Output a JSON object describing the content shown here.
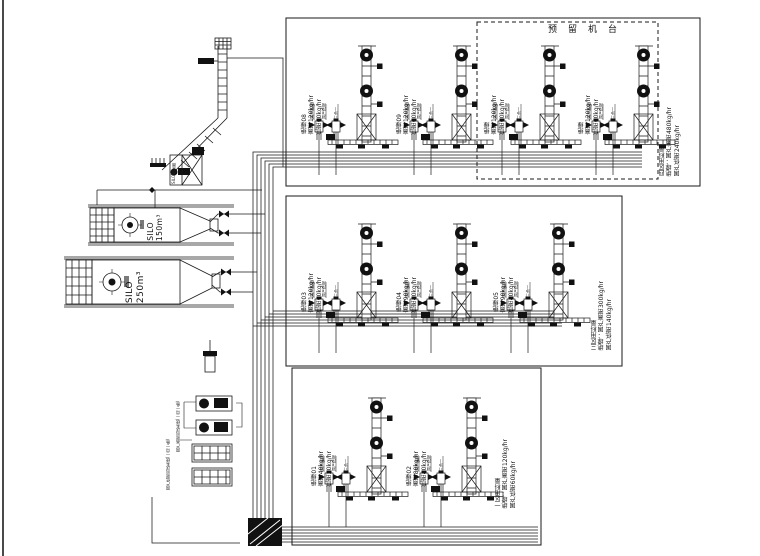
{
  "page": {
    "background": "#ffffff",
    "line_color": "#1a1a1a"
  },
  "reserved_area_label": "预留机台",
  "machines": {
    "m01": {
      "name": "绝缘01",
      "high": "高密40kg/hr",
      "low": "低密20kg/hr"
    },
    "m02": {
      "name": "绝缘02",
      "high": "高密80kg/hr",
      "low": "低密40kg/hr"
    },
    "m03": {
      "name": "绝缘03",
      "high": "高密120kg/hr",
      "low": "低密60kg/hr"
    },
    "m04": {
      "name": "绝缘04",
      "high": "高密90kg/hr",
      "low": "低密40kg/hr"
    },
    "m05": {
      "name": "绝缘05",
      "high": "高密90kg/hr",
      "low": "低密40kg/hr"
    },
    "m08": {
      "name": "绝缘08",
      "high": "高密120kg/hr",
      "low": "低密60kg/hr"
    },
    "m09": {
      "name": "绝缘09",
      "high": "高密120kg/hr",
      "low": "低密60kg/hr"
    },
    "r1": {
      "name": "绝缘",
      "high": "高密120kg/hr",
      "low": "低密60kg/hr"
    },
    "r2": {
      "name": "绝缘",
      "high": "高密120kg/hr",
      "low": "低密60kg/hr"
    }
  },
  "zone_notes": {
    "zone4": {
      "title": "四区用料量",
      "line1": "绝缘：国产高密480kg/hr",
      "line2": "国产低密240kg/hr"
    },
    "zone3": {
      "title": "三区用料量",
      "line1": "绝缘：国产高密300kg/hr",
      "line2": "国产低密140kg/hr"
    },
    "zone1": {
      "title": "一区用料量",
      "line1": "绝缘：国产高密120kg/hr",
      "line2": "国产低密60kg/hr"
    }
  },
  "machine_symbol": {
    "port_labels": [
      "国产高密",
      "国产低密",
      "三合一"
    ]
  },
  "silos": {
    "silo1": {
      "label": "SILO",
      "capacity": "150m³"
    },
    "silo2": {
      "label": "SILO",
      "capacity": "250m³"
    }
  },
  "equipment": {
    "dust_collector": "SILO除尘器",
    "blower_high": "国产高密风送系统(一用一备)",
    "blower_low": "国产低密风送系统(一用一备)"
  }
}
